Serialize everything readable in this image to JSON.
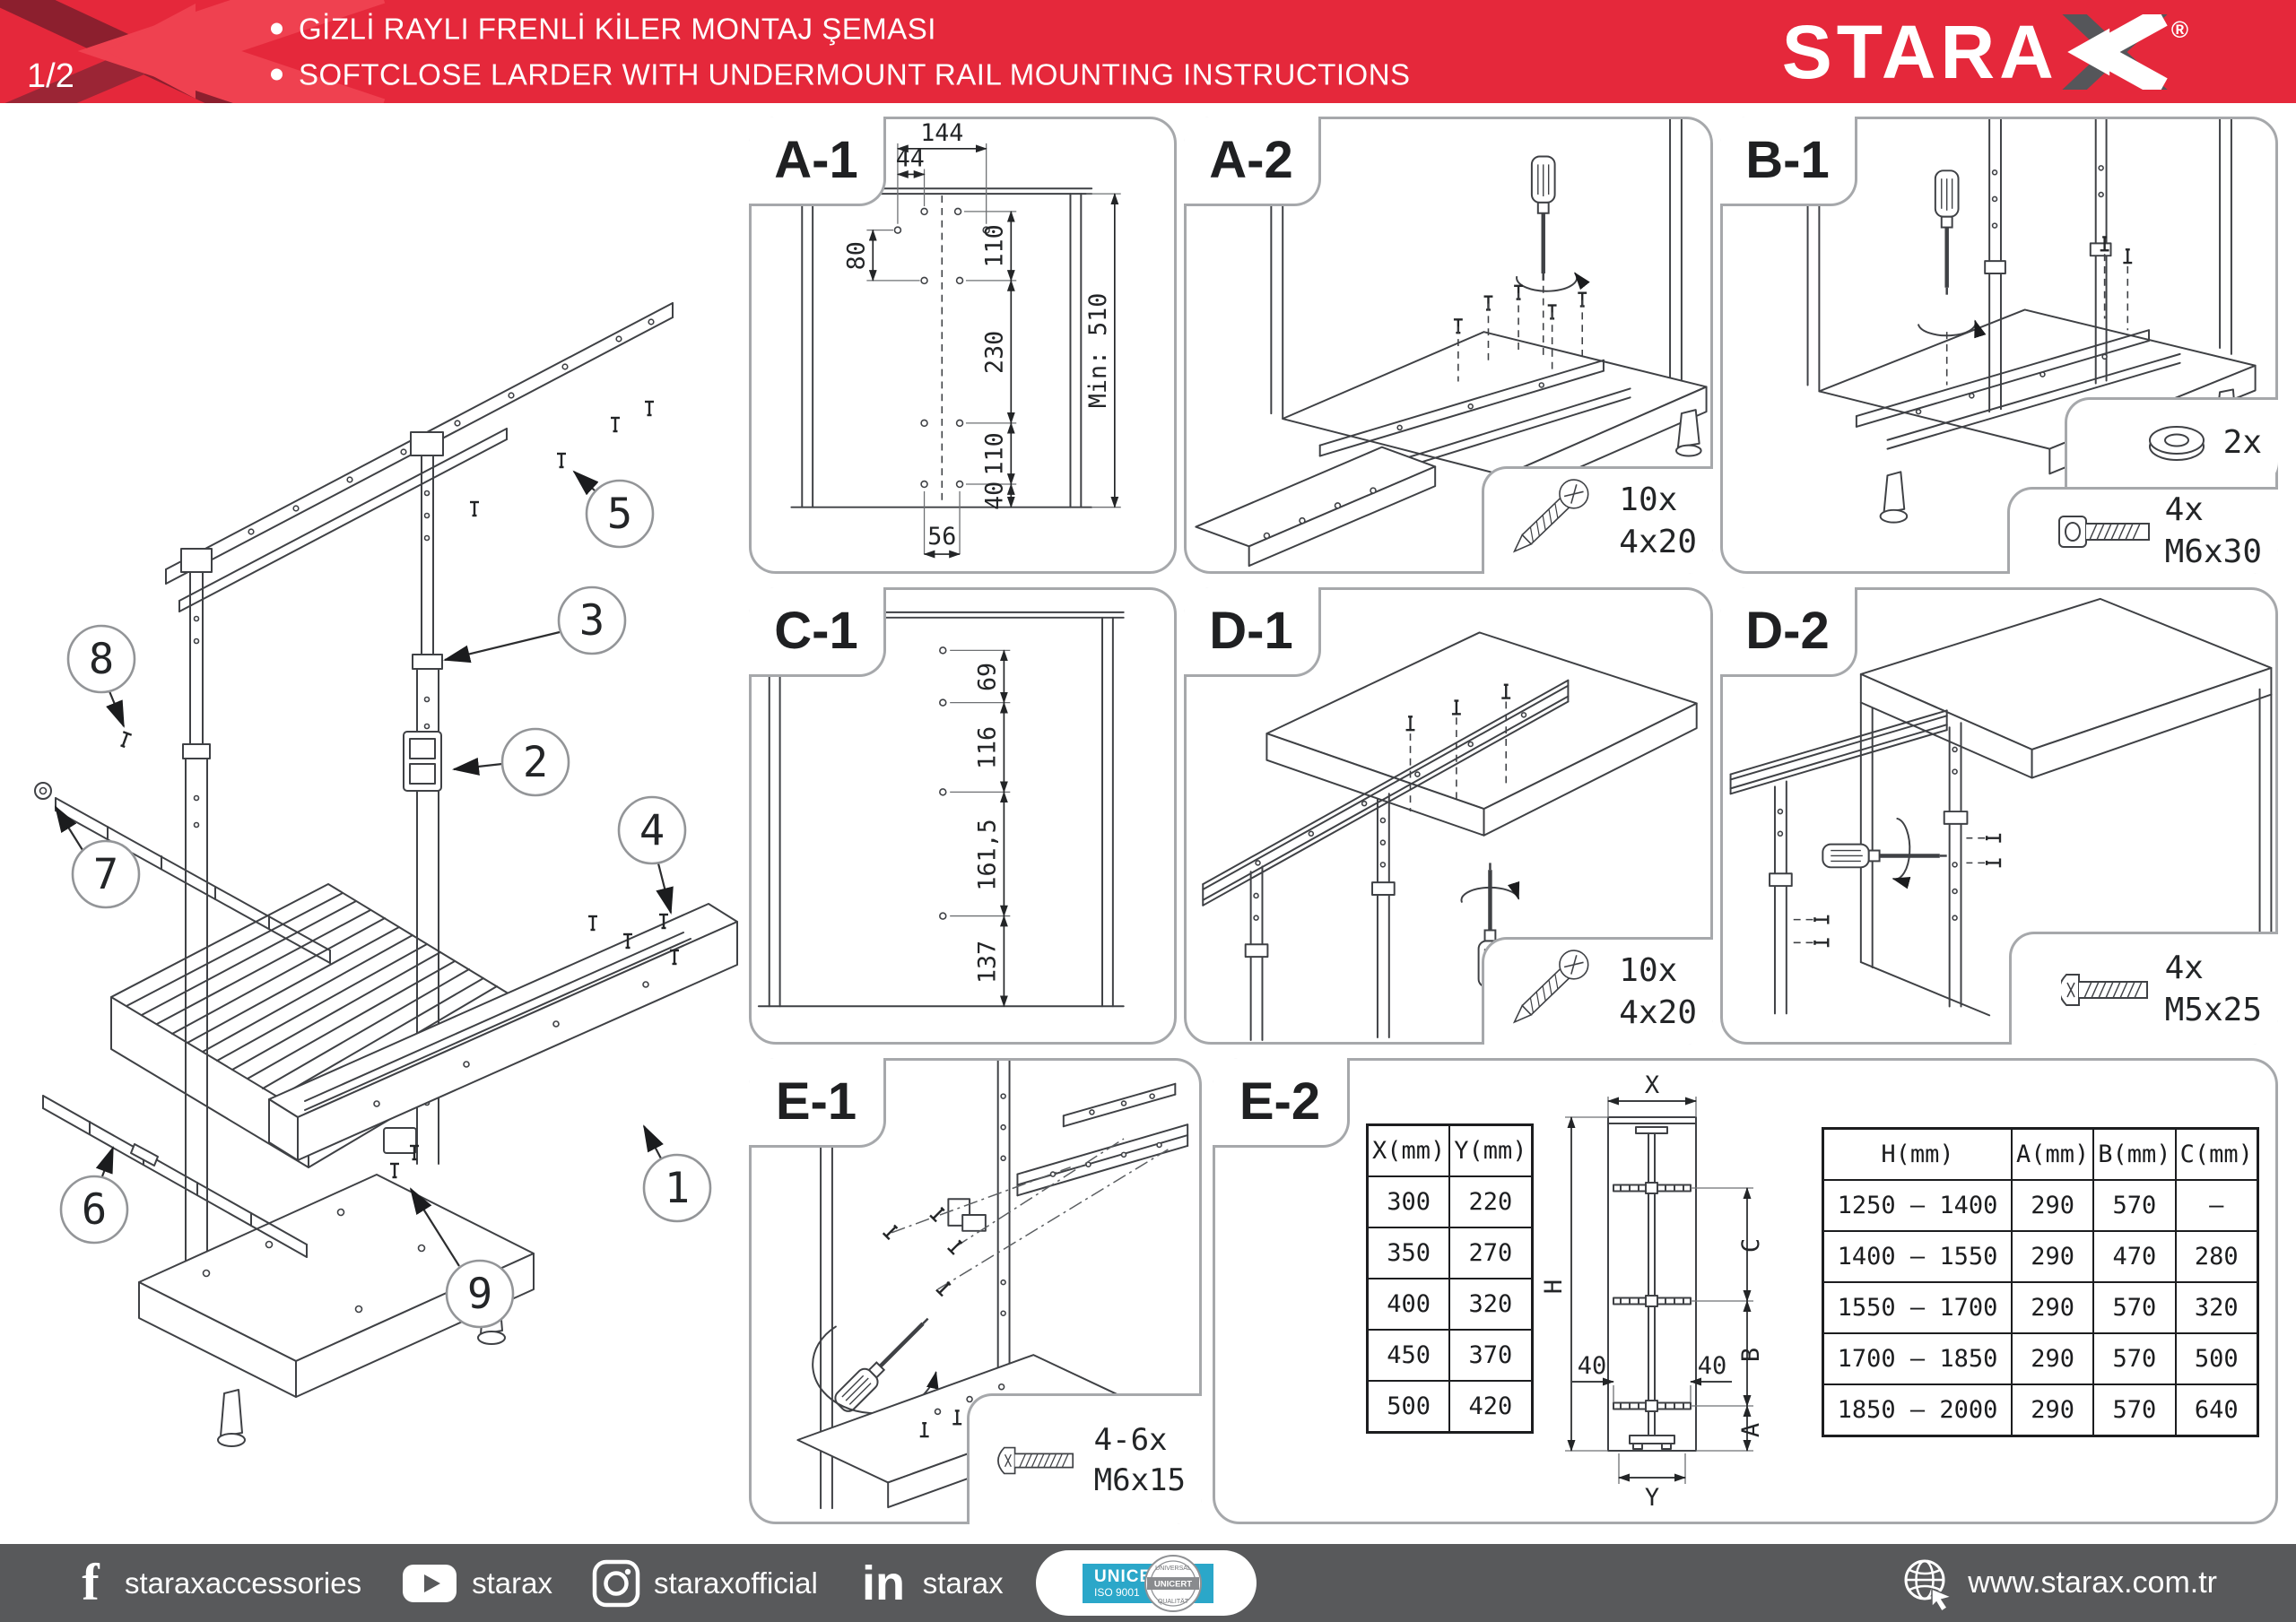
{
  "page": {
    "number": "1/2"
  },
  "header": {
    "bullet1": "GİZLİ RAYLI FRENLİ KİLER MONTAJ ŞEMASI",
    "bullet2": "SOFTCLOSE LARDER WITH UNDERMOUNT RAIL MOUNTING INSTRUCTIONS",
    "brand": "STARAX",
    "brand_letters": "STARA",
    "registered": "®"
  },
  "colors": {
    "header_red": "#e5283b",
    "motif_dark": "#8c1f2e",
    "arrow_red": "#ef4150",
    "footer_gray": "#58595b",
    "cert_teal": "#2ba7c9",
    "logo_x_gray": "#55565a"
  },
  "main_diagram": {
    "callouts": [
      "1",
      "2",
      "3",
      "4",
      "5",
      "6",
      "7",
      "8",
      "9"
    ]
  },
  "panels": {
    "a1": {
      "label": "A-1",
      "dims": {
        "w144": "144",
        "w44": "44",
        "h80": "80",
        "h110a": "110",
        "h230": "230",
        "h110b": "110",
        "h40": "40",
        "w56": "56",
        "min510": "Min: 510"
      }
    },
    "a2": {
      "label": "A-2",
      "inset": {
        "count": "10x",
        "size": "4x20"
      }
    },
    "b1": {
      "label": "B-1",
      "washer": {
        "count": "2x"
      },
      "bolt": {
        "count": "4x",
        "size": "M6x30"
      }
    },
    "c1": {
      "label": "C-1",
      "dims": {
        "h69": "69",
        "h116": "116",
        "h161": "161,5",
        "h137": "137"
      }
    },
    "d1": {
      "label": "D-1",
      "inset": {
        "count": "10x",
        "size": "4x20"
      }
    },
    "d2": {
      "label": "D-2",
      "inset": {
        "count": "4x",
        "size": "M5x25"
      }
    },
    "e1": {
      "label": "E-1",
      "inset": {
        "count": "4-6x",
        "size": "M6x15"
      }
    },
    "e2": {
      "label": "E-2",
      "xy_table": {
        "headers": [
          "X(mm)",
          "Y(mm)"
        ],
        "rows": [
          [
            "300",
            "220"
          ],
          [
            "350",
            "270"
          ],
          [
            "400",
            "320"
          ],
          [
            "450",
            "370"
          ],
          [
            "500",
            "420"
          ]
        ]
      },
      "h_table": {
        "headers": [
          "H(mm)",
          "A(mm)",
          "B(mm)",
          "C(mm)"
        ],
        "rows": [
          [
            "1250 – 1400",
            "290",
            "570",
            "–"
          ],
          [
            "1400 – 1550",
            "290",
            "470",
            "280"
          ],
          [
            "1550 – 1700",
            "290",
            "570",
            "320"
          ],
          [
            "1700 – 1850",
            "290",
            "570",
            "500"
          ],
          [
            "1850 – 2000",
            "290",
            "570",
            "640"
          ]
        ]
      },
      "diagram": {
        "x": "X",
        "y": "Y",
        "h": "H",
        "a": "A",
        "b": "B",
        "c": "C",
        "left40": "40",
        "right40": "40"
      }
    }
  },
  "footer": {
    "social": [
      {
        "name": "facebook",
        "handle": "staraxaccessories"
      },
      {
        "name": "youtube",
        "handle": "starax"
      },
      {
        "name": "instagram",
        "handle": "staraxofficial"
      },
      {
        "name": "linkedin",
        "handle": "starax"
      }
    ],
    "certificate": {
      "name": "UNICERT",
      "standard": "ISO 9001",
      "seal_text": "UNICERT",
      "seal_top": "UNIVERSAL",
      "seal_bottom": "QUALITÄT"
    },
    "website": "www.starax.com.tr"
  }
}
